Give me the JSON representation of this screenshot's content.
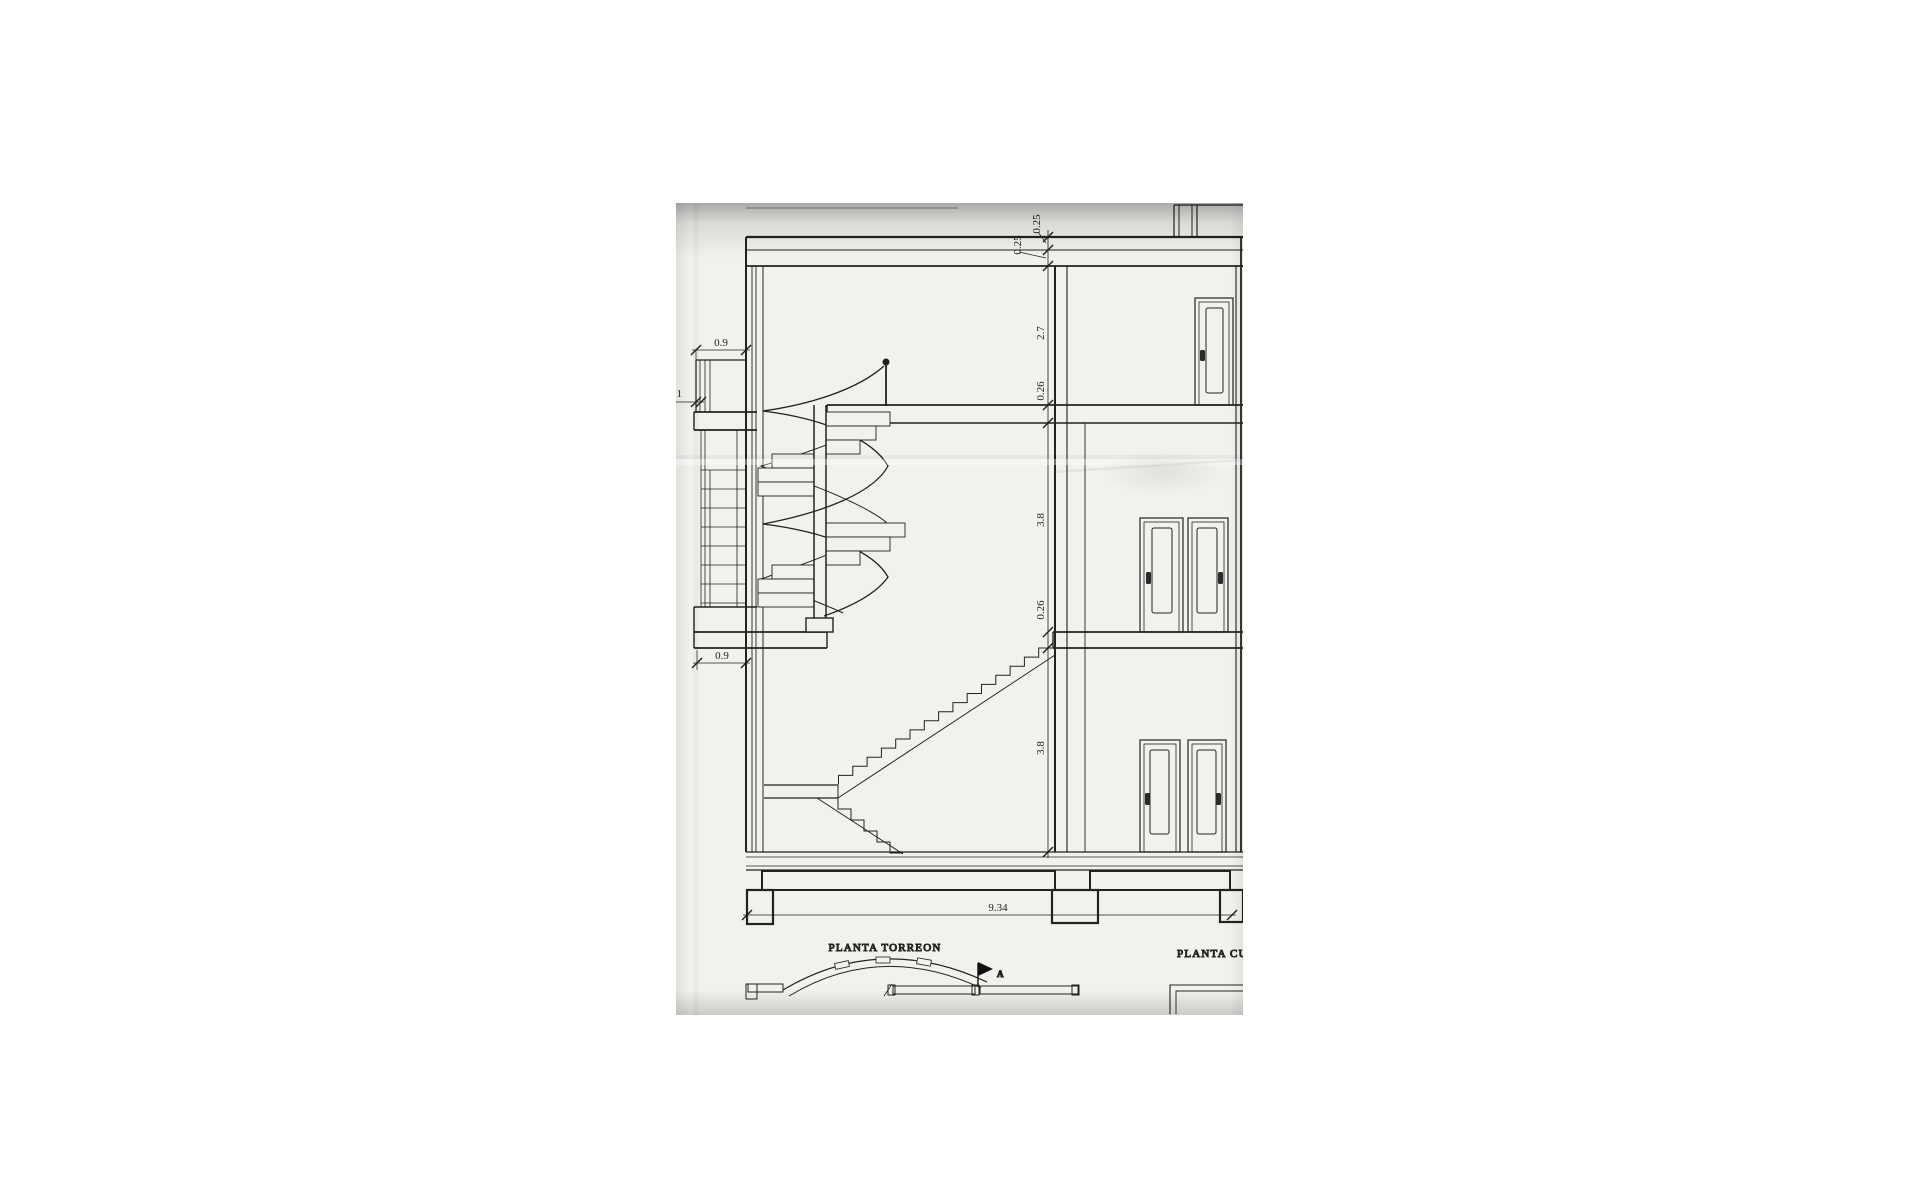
{
  "sheet": {
    "dims": {
      "balcony_width_top": "0.9",
      "balcony_offset": ".1",
      "balcony_width_bottom": "0.9",
      "roof_edge_upper": "0.25",
      "roof_edge_lower": "0.25",
      "top_floor_height": "2.7",
      "upper_slab": "0.26",
      "mid_floor_height": "3.8",
      "lower_slab": "0.26",
      "ground_floor_height": "3.8",
      "overall_width": "9.34"
    },
    "titles": {
      "left_plan": "PLANTA TORREON",
      "right_plan": "PLANTA CUBIERT",
      "section_marker": "A"
    },
    "colors": {
      "paper": "#f2f1ee",
      "ink": "#1f1f1f",
      "background": "#ffffff"
    }
  }
}
